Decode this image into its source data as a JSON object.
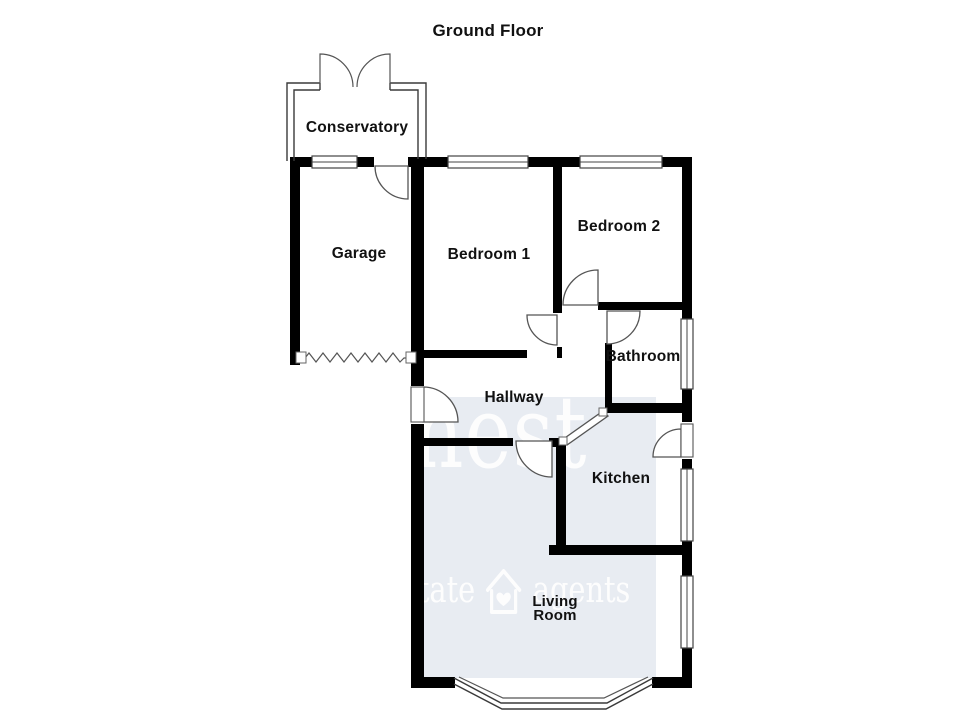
{
  "title": "Ground Floor",
  "rooms": {
    "conservatory": "Conservatory",
    "garage": "Garage",
    "bedroom1": "Bedroom 1",
    "bedroom2": "Bedroom 2",
    "bathroom": "Bathroom",
    "hallway": "Hallway",
    "kitchen": "Kitchen",
    "living_room": "Living Room"
  },
  "watermark": {
    "brand": "nest",
    "tagline_left": "estate",
    "tagline_right": "agents",
    "house_icon": "house-heart-icon",
    "bg_color": "#e8ecf2",
    "text_color": "#ffffff"
  },
  "colors": {
    "wall": "#000000",
    "background": "#ffffff",
    "label_text": "#111111"
  }
}
